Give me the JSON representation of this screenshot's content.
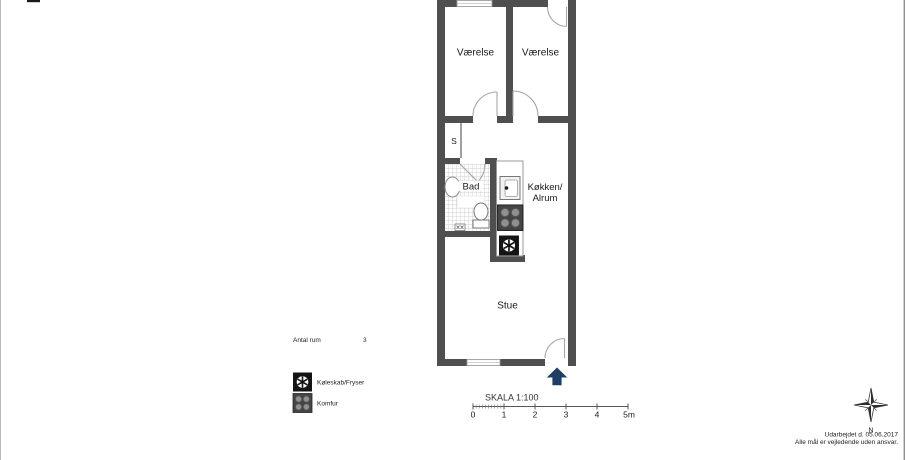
{
  "plan": {
    "rooms": {
      "bedroom_left": "Værelse",
      "bedroom_right": "Værelse",
      "closet": "S",
      "bath": "Bad",
      "kitchen_line1": "Køkken/",
      "kitchen_line2": "Alrum",
      "living": "Stue"
    }
  },
  "legend": {
    "rooms_count_label": "Antal rum",
    "rooms_count_value": "3",
    "fridge_label": "Køleskab/Fryser",
    "stove_label": "Komfur"
  },
  "scalebar": {
    "title": "SKALA 1:100",
    "ticks": [
      "0",
      "1",
      "2",
      "3",
      "4",
      "5m"
    ]
  },
  "compass": {
    "north_label": "N"
  },
  "footer": {
    "line1": "Udarbejdet d. 05.06.2017",
    "line2": "Alle mål er vejledende uden ansvar."
  },
  "colors": {
    "wall": "#4f4f4f",
    "entrance_arrow": "#1e3f63",
    "door_arc": "#a6a6a6",
    "tile_line": "#c4c4c4"
  }
}
